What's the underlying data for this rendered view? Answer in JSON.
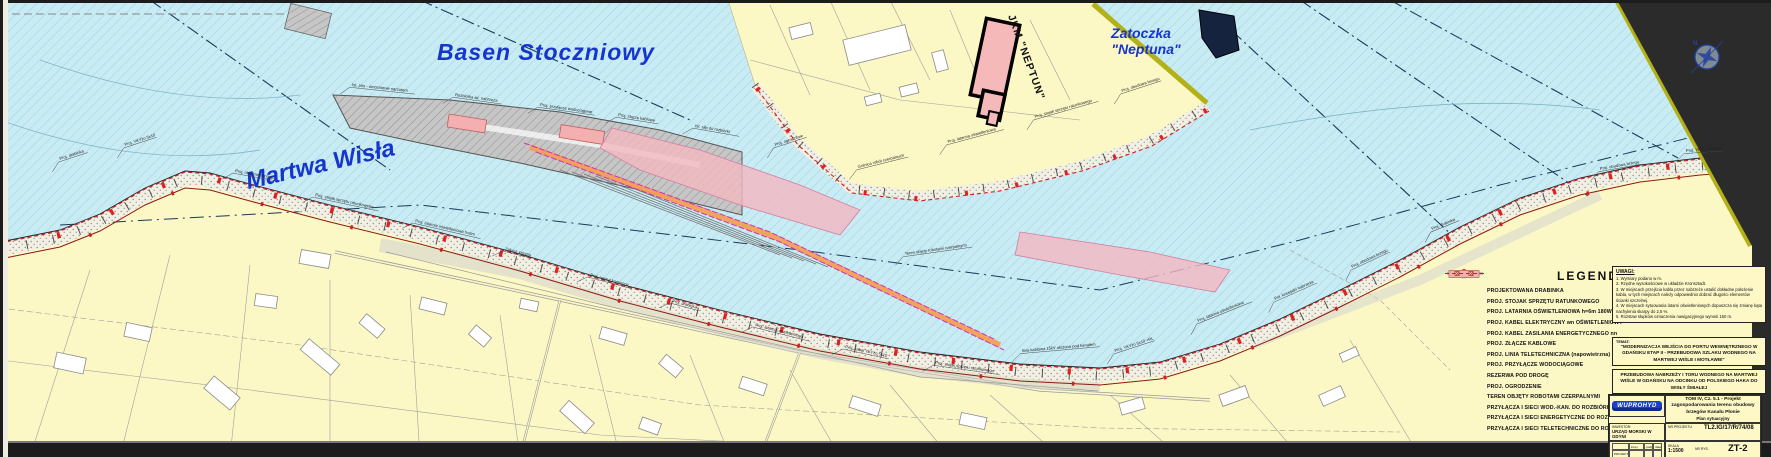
{
  "map": {
    "water_labels": {
      "basen": "Basen Stoczniowy",
      "martwa": "Martwa Wisła",
      "zatoczka_line1": "Zatoczka",
      "zatoczka_line2": "\"Neptuna\""
    },
    "building_label": "JKM \"NEPTUN\"",
    "compass": "N",
    "annotations": [
      {
        "x": 60,
        "y": 160,
        "r": -18,
        "t": "Proj. drabinka"
      },
      {
        "x": 125,
        "y": 146,
        "r": -18,
        "t": "Proj. YKYżo 5x10"
      },
      {
        "x": 235,
        "y": 172,
        "r": 10,
        "t": "Proj. obudowa brzegu"
      },
      {
        "x": 315,
        "y": 196,
        "r": 12,
        "t": "Proj. stojak sprzętu ratunkowego"
      },
      {
        "x": 415,
        "y": 222,
        "r": 13,
        "t": "Proj. latarnia oświetleniowa h=6m"
      },
      {
        "x": 505,
        "y": 250,
        "r": 14,
        "t": "Zakres zasypu"
      },
      {
        "x": 590,
        "y": 276,
        "r": 15,
        "t": "Proj. narzut kamienny"
      },
      {
        "x": 672,
        "y": 302,
        "r": 15,
        "t": "Proj. drabinka"
      },
      {
        "x": 755,
        "y": 326,
        "r": 14,
        "t": "Proj. latarnia oświetleniowa"
      },
      {
        "x": 845,
        "y": 348,
        "r": 12,
        "t": "Proj. kabel YKYżo 5x10"
      },
      {
        "x": 935,
        "y": 364,
        "r": 8,
        "t": "Proj. stojak sprzętu ratunkowego"
      },
      {
        "x": 1022,
        "y": 352,
        "r": -5,
        "t": "linia kablowa 15kV ułożona pod kanałem"
      },
      {
        "x": 1115,
        "y": 352,
        "r": -18,
        "t": "Proj. YKYżo 5x10 +RL"
      },
      {
        "x": 1198,
        "y": 322,
        "r": -22,
        "t": "Proj. latarnia oświetleniowa"
      },
      {
        "x": 1275,
        "y": 300,
        "r": -24,
        "t": "Poł. krawędzi nabrzeża"
      },
      {
        "x": 1352,
        "y": 268,
        "r": -25,
        "t": "Proj. obudowa brzegu"
      },
      {
        "x": 1432,
        "y": 230,
        "r": -22,
        "t": "Proj. drabinka"
      },
      {
        "x": 1600,
        "y": 170,
        "r": -10,
        "t": "Proj. obudowa brzegu"
      },
      {
        "x": 1686,
        "y": 152,
        "r": -4,
        "t": "Proj. YKY 4x10 +RL"
      },
      {
        "x": 352,
        "y": 86,
        "r": 6,
        "t": "Ist. pirs - umocnienie narzutem"
      },
      {
        "x": 455,
        "y": 96,
        "r": 8,
        "t": "Rozbiórka ist. nabrzeża"
      },
      {
        "x": 540,
        "y": 106,
        "r": 8,
        "t": "Proj. przyłącze wodociągowe"
      },
      {
        "x": 618,
        "y": 116,
        "r": 9,
        "t": "Proj. złącze kablowe"
      },
      {
        "x": 695,
        "y": 127,
        "r": 10,
        "t": "Ist. slip do rozbiórki"
      },
      {
        "x": 775,
        "y": 146,
        "r": -18,
        "t": "Proj. ogrodzenie"
      },
      {
        "x": 858,
        "y": 168,
        "r": -14,
        "t": "Granica robót czerpalnych"
      },
      {
        "x": 948,
        "y": 143,
        "r": -15,
        "t": "Proj. latarnia oświetleniowa"
      },
      {
        "x": 1035,
        "y": 118,
        "r": -16,
        "t": "Proj. stojak sprzętu ratunkowego"
      },
      {
        "x": 1122,
        "y": 92,
        "r": -18,
        "t": "Proj. obudowa brzegu"
      },
      {
        "x": 905,
        "y": 255,
        "r": -8,
        "t": "Teren objęty robotami czerpalnymi"
      }
    ]
  },
  "legend": {
    "title": "LEGENDA",
    "items": [
      {
        "symbol": "ladder",
        "label": "PROJEKTOWANA DRABINKA"
      },
      {
        "symbol": "rescue-stand",
        "label": "PROJ. STOJAK SPRZĘTU RATUNKOWEGO"
      },
      {
        "symbol": "lamp",
        "label": "PROJ. LATARNIA OŚWIETLENIOWA h=6m 180W - 12 szt."
      },
      {
        "symbol": "cable-lighting",
        "label": "PROJ. KABEL ELEKTRYCZNY wn OŚWIETLENIOWY"
      },
      {
        "symbol": "cable-power",
        "label": "PROJ. KABEL ZASILANIA ENERGETYCZNEGO nn"
      },
      {
        "symbol": "cable-joint",
        "label": "PROJ. ZŁĄCZE KABLOWE"
      },
      {
        "symbol": "telecom-line",
        "label": "PROJ. LINIA TELETECHNICZNA (napowietrzna)"
      },
      {
        "symbol": "water-supply",
        "label": "PROJ. PRZYŁĄCZE WODOCIĄGOWE"
      },
      {
        "symbol": "road-reserve",
        "label": "REZERWA POD DROGĘ"
      },
      {
        "symbol": "fence",
        "label": "PROJ. OGRODZENIE"
      },
      {
        "symbol": "dredging-area",
        "label": "TEREN OBJĘTY ROBOTAMI CZERPALNYMI"
      },
      {
        "symbol": "demol-water",
        "label": "PRZYŁĄCZA I SIECI WOD.-KAN. DO ROZBIÓRKI"
      },
      {
        "symbol": "demol-power",
        "label": "PRZYŁĄCZA I SIECI ENERGETYCZNE DO ROZBIÓRKI"
      },
      {
        "symbol": "demol-telecom",
        "label": "PRZYŁĄCZA I SIECI TELETECHNICZNE DO ROZBIÓRKI"
      }
    ],
    "rescue_stand_prefix": "SL"
  },
  "notes": {
    "title": "UWAGI:",
    "items": [
      "1. Wymiary podano w m.",
      "2. Rzędne wysokościowe w układzie Kronsztadt.",
      "3. W miejscach przejścia kabla przez nabrzeże ustalić dokładne położenie kabla, w tych miejscach należy odpowiednio dobrać długości elementów ścianki szczelnej.",
      "4. W miejscach sytuowania latarni oświetleniowych dopuszcza się zmianę kąta nachylenia skarpy do 2,5 %.",
      "5. Rozstaw słupków oznaczenia nawigacyjnego wynosi 150 m."
    ]
  },
  "project_boxes": {
    "box1_label": "TEMAT:",
    "box1": "\"MODERNIZACJA WEJŚCIA DO PORTU WEWNĘTRZNEGO W GDAŃSKU ETAP II - PRZEBUDOWA SZLAKU WODNEGO NA MARTWEJ WIŚLE I MOTŁAWIE\"",
    "box2": "PRZEBUDOWA NABRZEŻY I TORU WODNEGO NA MARTWEJ WIŚLE W GDAŃSKU NA ODCINKU OD POLSKIEGO HAKA DO WISŁY ŚMIAŁEJ"
  },
  "title_block": {
    "company": "WUPROHYD",
    "investor_label": "INWESTOR:",
    "investor": "URZĄD MORSKI W GDYNI",
    "sign_cols": [
      "imię i nazwisko",
      "podpis",
      "data"
    ],
    "sign_rows": [
      "PROJEKTOWAŁ",
      "OPRACOWAŁ",
      "SPRAWDZIŁ"
    ],
    "volume_title": "TOM IV, Cz. 5.1 - Projekt zagospodarowania terenu obudowy brzegów Kanału Płonie",
    "drawing_title": "Plan sytuacyjny",
    "project_no_label": "NR PROJEKTU",
    "project_no": "TL2.IG/17/R/74/08",
    "scale_label": "SKALA",
    "scale": "1:1500",
    "sheet_label": "NR RYS.",
    "sheet": "ZT-2"
  },
  "colors": {
    "water": "#c9ecf4",
    "land": "#fcf8c6",
    "shoreline_accent": "#b3b117",
    "lamp_red": "#e02020",
    "cable_dark_red": "#8b1a1a",
    "road_reserve_orange": "#f2a055",
    "dredging_pink": "#f4b0b0",
    "fence_magenta": "#d030c0",
    "label_blue": "#1535cc"
  }
}
